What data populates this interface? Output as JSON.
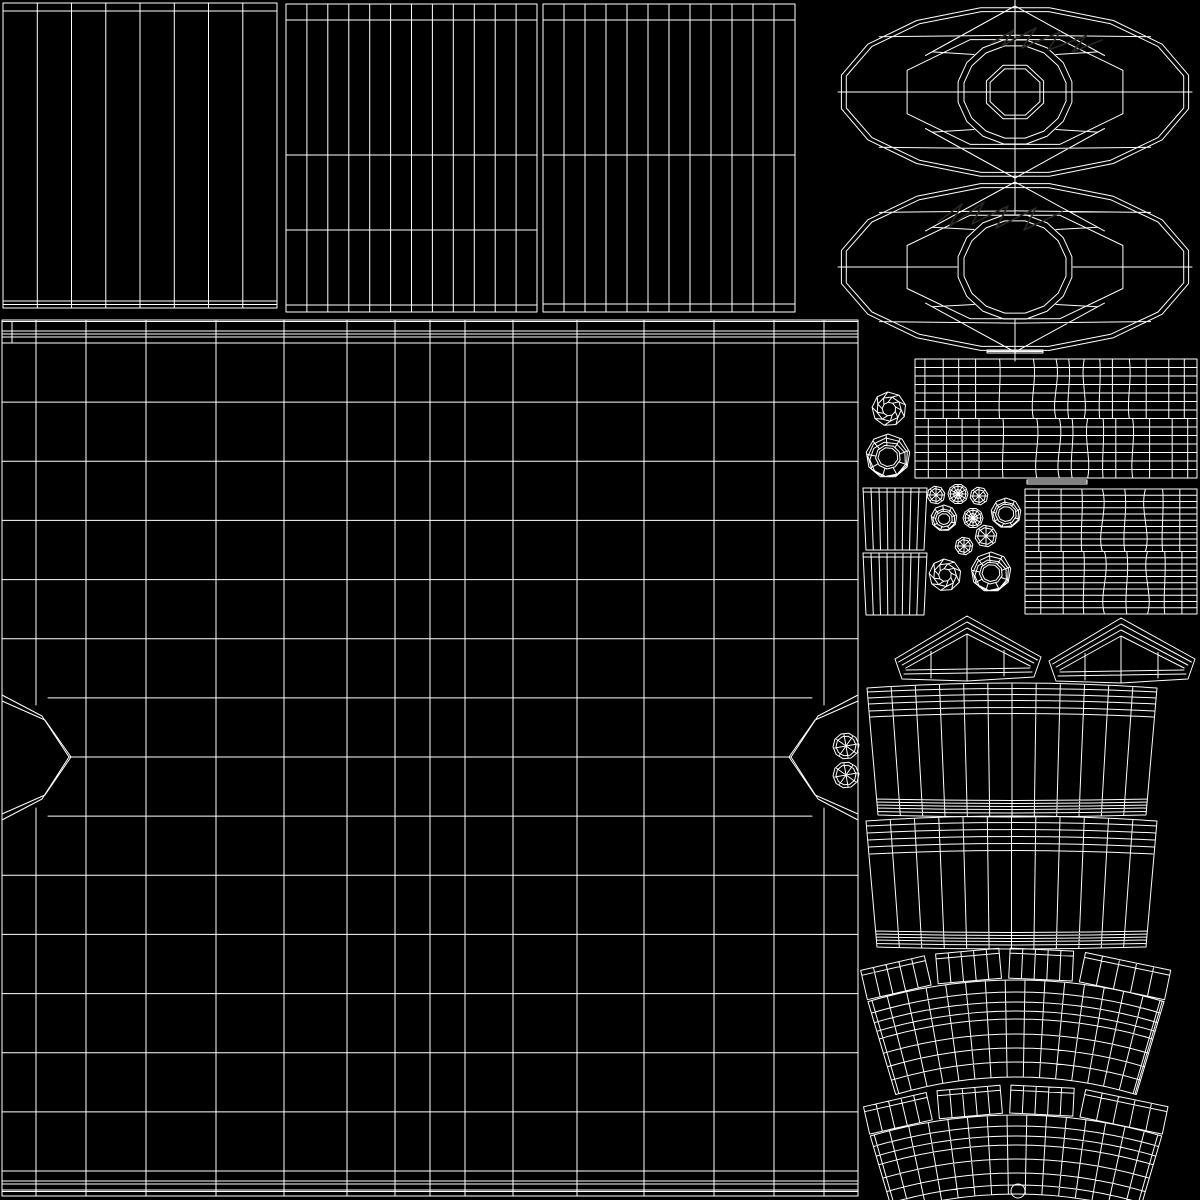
{
  "canvas": {
    "width": 1200,
    "height": 1200,
    "background_color": "#000000",
    "line_color": "#ffffff",
    "faint_line_color": "#2a2622",
    "line_width": 1
  },
  "islands": [
    {
      "type": "striped_panel",
      "name": "panel-top-left",
      "x": 3,
      "y": 3,
      "w": 274,
      "h": 305,
      "cols": 8,
      "rows": [
        8
      ],
      "bottom_lines": [
        7,
        3.5
      ]
    },
    {
      "type": "striped_panel",
      "name": "panel-top-middle",
      "x": 286,
      "y": 4,
      "w": 251,
      "h": 308,
      "cols": 12,
      "rows": [
        16,
        151,
        226,
        301
      ]
    },
    {
      "type": "striped_panel",
      "name": "panel-top-right",
      "x": 543,
      "y": 4,
      "w": 252,
      "h": 308,
      "cols": 12,
      "rows": [
        16,
        151,
        300
      ]
    },
    {
      "type": "wheel",
      "name": "wheel-disc-with-hub",
      "cx": 1015,
      "cy": 92,
      "rx": 177,
      "ry": 86,
      "hub": true
    },
    {
      "type": "wheel",
      "name": "wheel-disc-open",
      "cx": 1015,
      "cy": 267,
      "rx": 177,
      "ry": 85,
      "hub": false
    },
    {
      "type": "scribble",
      "name": "faint-marks-upper",
      "color": "faint",
      "points": [
        [
          990,
          44
        ],
        [
          1014,
          30
        ],
        [
          1002,
          46
        ],
        [
          1036,
          28
        ],
        [
          1022,
          48
        ],
        [
          1060,
          32
        ],
        [
          1048,
          50
        ],
        [
          1086,
          36
        ],
        [
          1072,
          52
        ],
        [
          1102,
          40
        ]
      ]
    },
    {
      "type": "scribble",
      "name": "faint-marks-lower",
      "color": "faint",
      "points": [
        [
          938,
          222
        ],
        [
          962,
          204
        ],
        [
          950,
          226
        ],
        [
          984,
          202
        ],
        [
          972,
          224
        ],
        [
          1008,
          206
        ],
        [
          996,
          228
        ],
        [
          1036,
          208
        ],
        [
          1024,
          230
        ],
        [
          1062,
          212
        ]
      ]
    },
    {
      "type": "facet_ball",
      "name": "faceted-knob-large",
      "cx": 889,
      "cy": 409,
      "r": 17
    },
    {
      "type": "nut",
      "name": "ring-nut-large",
      "cx": 888,
      "cy": 456,
      "r": 22,
      "hole": 10,
      "rings": 3
    },
    {
      "type": "tread",
      "name": "tread-strip-upper",
      "x": 915,
      "y": 359,
      "w": 282,
      "h": 119,
      "hlines": 6,
      "verts": [
        {
          "p": 0.035
        },
        {
          "p": 0.1
        },
        {
          "p": 0.155
        },
        {
          "p": 0.215
        },
        {
          "p": 0.3,
          "c": 2
        },
        {
          "p": 0.42,
          "c": 4
        },
        {
          "p": 0.5,
          "c": 5
        },
        {
          "p": 0.545,
          "c": 3
        },
        {
          "p": 0.6,
          "c": -4
        },
        {
          "p": 0.655,
          "c": 2
        },
        {
          "p": 0.7
        },
        {
          "p": 0.76,
          "c": 3
        },
        {
          "p": 0.82
        },
        {
          "p": 0.9
        },
        {
          "p": 0.955
        }
      ]
    },
    {
      "type": "sliver",
      "name": "seam-tab-a",
      "x": 987,
      "y": 350,
      "w": 56,
      "h": 3
    },
    {
      "type": "sliver",
      "name": "seam-tab-b",
      "x": 1027,
      "y": 480,
      "w": 60,
      "h": 4
    },
    {
      "type": "striped_panel",
      "name": "side-cap-upper",
      "x": 863,
      "y": 488,
      "w": 64,
      "h": 62,
      "cols": 8,
      "rows": [
        4
      ],
      "taper": 3
    },
    {
      "type": "striped_panel",
      "name": "side-cap-lower",
      "x": 863,
      "y": 553,
      "w": 64,
      "h": 62,
      "cols": 8,
      "rows": [
        4
      ],
      "taper": 3
    },
    {
      "type": "tread",
      "name": "tread-strip-right",
      "x": 1025,
      "y": 489,
      "w": 172,
      "h": 125,
      "hlines": 9,
      "verts": [
        {
          "p": 0.08
        },
        {
          "p": 0.21
        },
        {
          "p": 0.33,
          "c": 2
        },
        {
          "p": 0.45,
          "c": 6
        },
        {
          "p": 0.58,
          "c": 3
        },
        {
          "p": 0.7,
          "c": -6
        },
        {
          "p": 0.8,
          "c": 2
        },
        {
          "p": 0.9
        }
      ]
    },
    {
      "type": "spoke_poly",
      "name": "bolt-a",
      "cx": 936,
      "cy": 495,
      "r": 9
    },
    {
      "type": "mesh_disc",
      "name": "gear-a",
      "cx": 958,
      "cy": 494,
      "r": 10
    },
    {
      "type": "spoke_poly",
      "name": "bolt-b",
      "cx": 979,
      "cy": 496,
      "r": 9
    },
    {
      "type": "nut",
      "name": "ring-nut-a",
      "cx": 944,
      "cy": 518,
      "r": 13,
      "hole": 6,
      "rings": 2
    },
    {
      "type": "mesh_disc",
      "name": "gear-b",
      "cx": 973,
      "cy": 518,
      "r": 10
    },
    {
      "type": "nut",
      "name": "ring-nut-b",
      "cx": 1006,
      "cy": 513,
      "r": 15,
      "hole": 8,
      "rings": 2
    },
    {
      "type": "spoke_poly",
      "name": "bolt-c",
      "cx": 964,
      "cy": 546,
      "r": 9
    },
    {
      "type": "spoke_poly",
      "name": "bolt-d",
      "cx": 986,
      "cy": 536,
      "r": 11
    },
    {
      "type": "facet_ball",
      "name": "faceted-knob-small",
      "cx": 945,
      "cy": 575,
      "r": 16
    },
    {
      "type": "nut",
      "name": "ring-nut-stacked",
      "cx": 991,
      "cy": 572,
      "r": 20,
      "hole": 9,
      "rings": 3
    },
    {
      "type": "roof",
      "name": "gable-left",
      "ax": 967,
      "ay": 616,
      "lx": 895,
      "ly": 659,
      "rx": 1041,
      "ry": 657,
      "base": 676
    },
    {
      "type": "roof",
      "name": "gable-right",
      "ax": 1121,
      "ay": 618,
      "lx": 1049,
      "ly": 661,
      "rx": 1195,
      "ry": 659,
      "base": 678
    },
    {
      "type": "barrel",
      "name": "barrel-panel-upper",
      "x0": 867,
      "x1": 1157,
      "y_top": 688,
      "y_bot": 815,
      "inset": 11,
      "cols": 12,
      "top_offsets": [
        4,
        10,
        16,
        23,
        29
      ],
      "bot_offsets": [
        16,
        13,
        10,
        7,
        3.5
      ]
    },
    {
      "type": "barrel",
      "name": "barrel-panel-lower",
      "x0": 866,
      "x1": 1157,
      "y_top": 821,
      "y_bot": 947,
      "inset": 11,
      "cols": 12,
      "top_offsets": [
        5,
        12,
        19,
        26,
        33
      ],
      "bot_offsets": [
        16,
        13,
        10,
        7,
        3.5
      ]
    },
    {
      "type": "fan",
      "name": "fender-arch-upper",
      "cx": 1016,
      "cy": 1498,
      "r_out": 518,
      "r_in": 421,
      "half_angle": 16.6,
      "rad_step": 2.2,
      "tab_h": 30,
      "arcs": [
        506,
        496,
        487,
        479,
        464,
        450,
        436
      ],
      "tabs": [
        [
          -16.6,
          -9.4
        ],
        [
          -8.6,
          -1.6
        ],
        [
          -0.8,
          6.2
        ],
        [
          7.0,
          16.6
        ]
      ]
    },
    {
      "type": "fan",
      "name": "fender-arch-lower",
      "cx": 1016,
      "cy": 1631,
      "r_out": 516,
      "r_in": 437,
      "half_angle": 16.4,
      "rad_step": 2.2,
      "tab_h": 28,
      "arcs": [
        505,
        495,
        486,
        472,
        458,
        446
      ],
      "tabs": [
        [
          -16.4,
          -9.3
        ],
        [
          -8.5,
          -1.5
        ],
        [
          -0.7,
          6.3
        ],
        [
          7.1,
          16.4
        ]
      ]
    },
    {
      "type": "circle",
      "name": "grommet-dot",
      "cx": 1018,
      "cy": 1191,
      "r": 7
    },
    {
      "type": "big_grid",
      "name": "hull-grid",
      "x0": 2,
      "y0": 320,
      "x1": 858,
      "y1": 1196,
      "top_band": [
        1.5,
        11,
        14,
        17,
        23
      ],
      "bottom_band": [
        25,
        15,
        12,
        6,
        4.5
      ],
      "cols": [
        36,
        86,
        146,
        216,
        284,
        347,
        395,
        430,
        465,
        513,
        577,
        644,
        714,
        774,
        824
      ],
      "row_y0": 343,
      "row_y1": 1171,
      "row_count": 14,
      "notch_left_outer": [
        [
          2,
          695
        ],
        [
          42,
          716
        ],
        [
          69,
          757
        ],
        [
          42,
          799
        ],
        [
          2,
          820
        ]
      ],
      "notch_left_inner": [
        [
          2,
          701
        ],
        [
          45,
          720
        ],
        [
          71,
          757
        ],
        [
          45,
          795
        ],
        [
          2,
          814
        ]
      ],
      "notch_right_outer": [
        [
          858,
          695
        ],
        [
          818,
          716
        ],
        [
          791,
          757
        ],
        [
          818,
          799
        ],
        [
          858,
          820
        ]
      ],
      "notch_right_inner": [
        [
          858,
          701
        ],
        [
          815,
          720
        ],
        [
          789,
          757
        ],
        [
          815,
          795
        ],
        [
          858,
          814
        ]
      ],
      "wheels": [
        {
          "cx": 846,
          "cy": 746,
          "r": 13
        },
        {
          "cx": 846,
          "cy": 775,
          "r": 13
        }
      ]
    }
  ]
}
